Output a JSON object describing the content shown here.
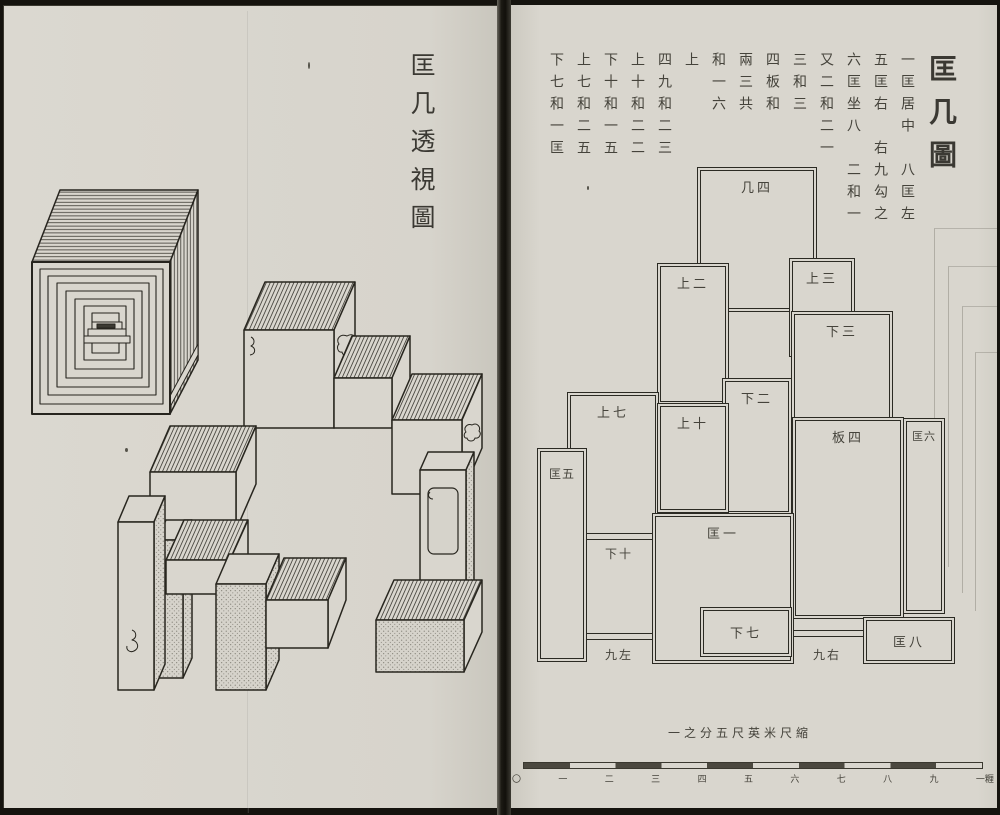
{
  "colors": {
    "ink": "#34322c",
    "page": "#d9d6ce",
    "frame": "#15130e"
  },
  "left_page": {
    "title": "匡几透視圖"
  },
  "right_page": {
    "title": "匡几圖",
    "text_columns": [
      "一匡居中　八匡左",
      "五匡右　右九勾之",
      "六匡坐八　二和一",
      "又二和二一",
      "三和三",
      "四板和",
      "兩三共",
      "和一六",
      "上",
      "四九和二三",
      "上十和二二",
      "下十和一五",
      "上七和二五",
      "下七和一匡"
    ],
    "diagram": {
      "box_labels": {
        "ji4": "几四",
        "shang2": "上二",
        "shang3": "上三",
        "xia3": "下三",
        "xia2": "下二",
        "shang7": "上七",
        "shang10": "上十",
        "ban4": "板四",
        "kuang6": "匡六",
        "kuang5": "匡五",
        "kuang1": "匡一",
        "xia7": "下七",
        "kuang8": "匡八"
      },
      "strip_labels": {
        "xia10": "下十",
        "jiuzuo": "九左",
        "jiuyou": "九右"
      }
    },
    "scale": {
      "caption": "一之分五尺英米尺縮",
      "tick_labels": [
        "〇",
        "一",
        "二",
        "三",
        "四",
        "五",
        "六",
        "七",
        "八",
        "九",
        "一糎"
      ]
    }
  }
}
